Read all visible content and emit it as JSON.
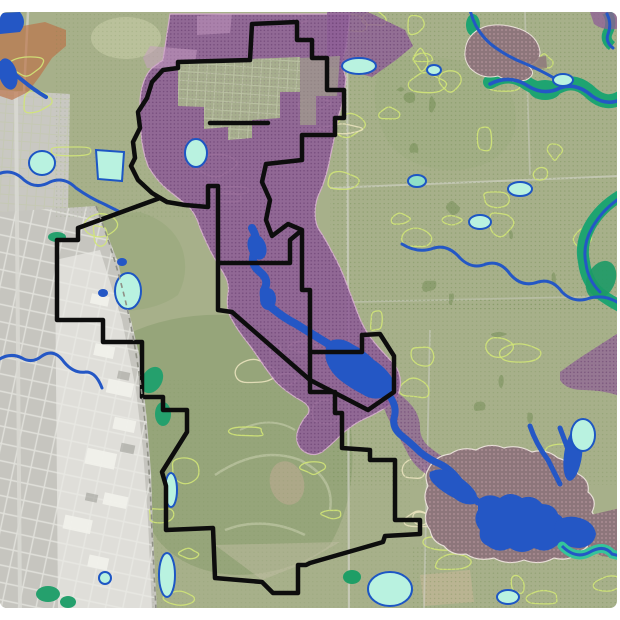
{
  "app": {
    "name": "gis-map-viewer",
    "view": "aerial-overlay-planning-map"
  },
  "frame": {
    "background": "#ffffff",
    "border_color": "#45453e",
    "margin_top_px": 12,
    "margin_bottom_px": 11,
    "corner_radius_px": 7
  },
  "colors": {
    "base": "#a7b08a",
    "base_light": "#bdc49e",
    "base_dark": "#93a377",
    "field_tan": "#c4b996",
    "urban": "#c6c5bf",
    "urban_top": "#c9c8c2",
    "urban_wash": "#e6e6e0",
    "building_white": "#f2f2ec",
    "orange_overlay": "#bd7045",
    "purple": "#8f5f97",
    "purple_dot": "#5b3164",
    "purple_pale": "#c9a0c6",
    "purple_edge": "#d9aed3",
    "mauve": "#8d767b",
    "mauve_dot": "#d4aeb6",
    "mauve_edge": "#e8e0d8",
    "water_blue": "#2457c5",
    "water_teal": "#1ea471",
    "teal_bright": "#35c49a",
    "pond_fill": "#b9f2e0",
    "pond_stroke": "#1d56c4",
    "contour": "#d2e678",
    "contour_cream": "#e9e2bd",
    "dot_green": "#5f7f3f",
    "boundary": "#0d0d0d",
    "dashed_line": "#8f9086",
    "road": "#d8d8d2"
  },
  "boundary": {
    "stroke_width_px": 4.5,
    "style": "solid"
  },
  "layers": [
    {
      "id": "base-land"
    },
    {
      "id": "urban-aerial"
    },
    {
      "id": "orange-land-use-overlay"
    },
    {
      "id": "vegetation-contours"
    },
    {
      "id": "stipple-dot-overlay"
    },
    {
      "id": "purple-designation-overlay"
    },
    {
      "id": "mauve-valley-overlay"
    },
    {
      "id": "watercourses"
    },
    {
      "id": "river-corridors"
    },
    {
      "id": "ponds"
    },
    {
      "id": "site-boundary"
    },
    {
      "id": "urban-edge-dashed"
    }
  ]
}
